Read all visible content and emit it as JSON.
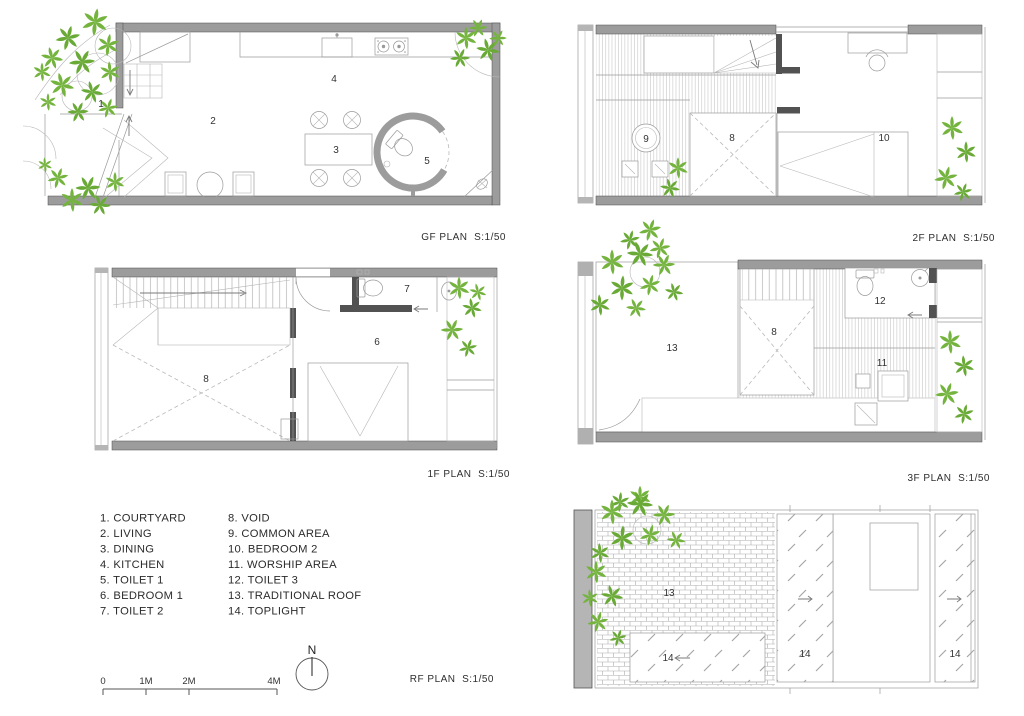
{
  "plans": {
    "gf": {
      "label": "GF PLAN  S:1/50",
      "rooms": [
        "1",
        "2",
        "3",
        "4",
        "5"
      ]
    },
    "f1": {
      "label": "1F PLAN  S:1/50",
      "rooms": [
        "8",
        "7",
        "6"
      ]
    },
    "f2": {
      "label": "2F PLAN  S:1/50",
      "rooms": [
        "9",
        "8",
        "10"
      ]
    },
    "f3": {
      "label": "3F PLAN  S:1/50",
      "rooms": [
        "13",
        "8",
        "12",
        "11"
      ]
    },
    "rf": {
      "label": "RF PLAN  S:1/50",
      "rooms": [
        "13",
        "14",
        "14",
        "14"
      ]
    }
  },
  "legend": {
    "col1": [
      "1. COURTYARD",
      "2. LIVING",
      "3. DINING",
      "4. KITCHEN",
      "5. TOILET 1",
      "6. BEDROOM 1",
      "7. TOILET 2"
    ],
    "col2": [
      "8. VOID",
      "9. COMMON AREA",
      "10. BEDROOM 2",
      "11. WORSHIP AREA",
      "12. TOILET 3",
      "13. TRADITIONAL ROOF",
      "14. TOPLIGHT"
    ]
  },
  "scale_bar": {
    "ticks": [
      "0",
      "1M",
      "2M",
      "4M"
    ]
  },
  "compass": {
    "label": "N"
  },
  "colors": {
    "wall_gray": "#9c9c9c",
    "dark_wall": "#525252",
    "line_gray": "#9a9a9a",
    "leaf_green": "#74b43e",
    "leaf_green_dark": "#69aa36",
    "text": "#2e2e2e"
  }
}
